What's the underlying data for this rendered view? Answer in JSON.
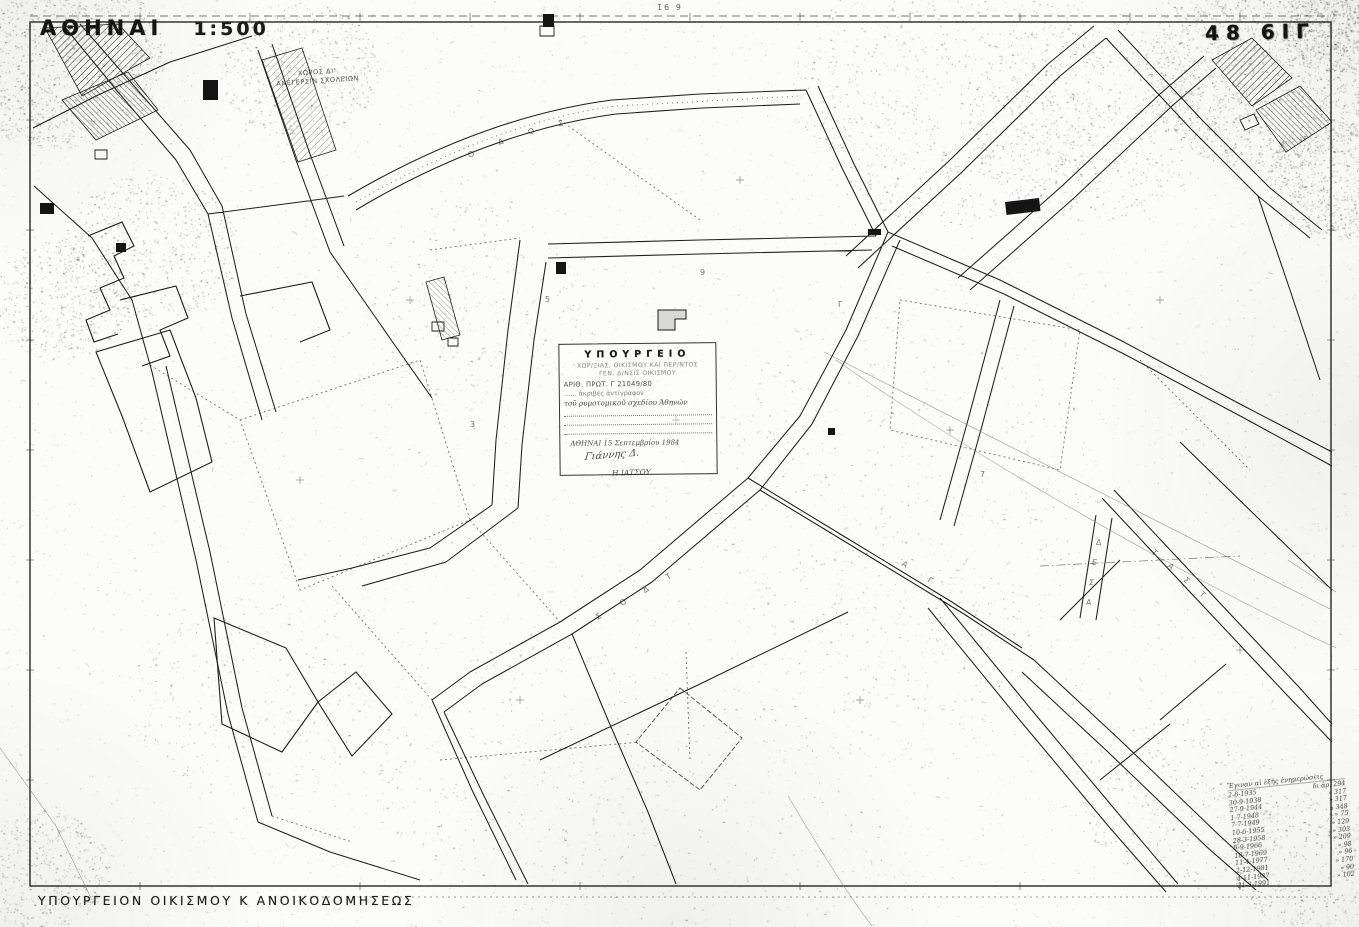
{
  "header": {
    "city": "ΑΘΗΝΑΙ",
    "scale": "1:500",
    "sheet": "48 6ΙΓ",
    "edge_note": "6 91"
  },
  "map_labels": {
    "school_line1": "ΧΩΡΟΣ ΔΙ'",
    "school_line2": "ΑΝΕΓΕΡΣΙΝ ΣΧΟΛΕΙΩΝ"
  },
  "stamp": {
    "title": "ΥΠΟΥΡΓΕΙΟ",
    "line2": "ΧΩΡ/ΞΙΑΣ, ΟΙΚΙΣΜΟΥ ΚΑΙ ΠΕΡ/ΝΤΟΣ",
    "line3": "ΓΕΝ. Δ/ΝΣΙΣ ΟΙΚΙΣΜΟΥ",
    "line4": "ΑΡΙΘ. ΠΡΩΤ. Γ 21049/80",
    "line5": "…… ἀκριβὲς ἀντίγραφον",
    "line6": "τοῦ ρυμοτομικοῦ σχεδίου Ἀθηνῶν",
    "date": "ΑΘΗΝΑΙ 15 Σεπτεμβρίου 1984",
    "signature": "Γιάννης Δ.",
    "below": "Η ΙΑΤΣΟΥ"
  },
  "footer": {
    "caption": "ΥΠΟΥΡΓΕΙΟΝ ΟΙΚΙΣΜΟΥ Κ ΑΝΟΙΚΟΔΟΜΗΣΕΩΣ"
  },
  "revisions": {
    "title": "Ἔγιναν αἱ ἑξῆς ἐνημερώσεις",
    "rows": [
      [
        "2-8-1935",
        "δι ἀρ. 294"
      ],
      [
        "30-9-1938",
        "» 317"
      ],
      [
        "27-9-1944",
        "» 317"
      ],
      [
        "1-7-1948",
        "» 348"
      ],
      [
        "7-7-1949",
        "» 75"
      ],
      [
        "10-6-1955",
        "» 129"
      ],
      [
        "28-3-1958",
        "» 303"
      ],
      [
        "9-9-1966",
        "» 209"
      ],
      [
        "10-7-1969",
        "» 98"
      ],
      [
        "11-4-1977",
        "» 96"
      ],
      [
        "2-12-1981",
        "» 170"
      ],
      [
        "4-11-1987",
        "» 90"
      ],
      [
        "21-3-1991",
        "» 102"
      ]
    ]
  },
  "street_letters": [
    {
      "c": "Σ",
      "x": 596,
      "y": 612,
      "r": -32
    },
    {
      "c": "Ο",
      "x": 620,
      "y": 598,
      "r": -32
    },
    {
      "c": "Δ",
      "x": 643,
      "y": 585,
      "r": -32
    },
    {
      "c": "Τ",
      "x": 666,
      "y": 572,
      "r": -32
    },
    {
      "c": "Δ",
      "x": 1096,
      "y": 538,
      "r": 8
    },
    {
      "c": "Ε",
      "x": 1092,
      "y": 558,
      "r": 8
    },
    {
      "c": "Σ",
      "x": 1089,
      "y": 578,
      "r": 8
    },
    {
      "c": "Α",
      "x": 1086,
      "y": 598,
      "r": 8
    },
    {
      "c": "Τ",
      "x": 1152,
      "y": 548,
      "r": 42
    },
    {
      "c": "Α",
      "x": 1168,
      "y": 562,
      "r": 42
    },
    {
      "c": "Σ",
      "x": 1184,
      "y": 576,
      "r": 42
    },
    {
      "c": "Τ",
      "x": 1200,
      "y": 590,
      "r": 42
    },
    {
      "c": "Ο",
      "x": 468,
      "y": 150,
      "r": -20
    },
    {
      "c": "Δ",
      "x": 498,
      "y": 137,
      "r": -18
    },
    {
      "c": "Ο",
      "x": 528,
      "y": 127,
      "r": -15
    },
    {
      "c": "Σ",
      "x": 558,
      "y": 119,
      "r": -12
    },
    {
      "c": "Α",
      "x": 902,
      "y": 560,
      "r": 30
    },
    {
      "c": "Γ",
      "x": 928,
      "y": 576,
      "r": 30
    },
    {
      "c": "5",
      "x": 545,
      "y": 295,
      "r": 0
    },
    {
      "c": "9",
      "x": 700,
      "y": 268,
      "r": 0
    },
    {
      "c": "Γ",
      "x": 838,
      "y": 300,
      "r": 0
    },
    {
      "c": "3",
      "x": 470,
      "y": 420,
      "r": 0
    },
    {
      "c": "7",
      "x": 980,
      "y": 470,
      "r": 0
    }
  ],
  "colors": {
    "ink": "#1c1c1c",
    "paper": "#fcfcfb",
    "faint": "#777777"
  }
}
